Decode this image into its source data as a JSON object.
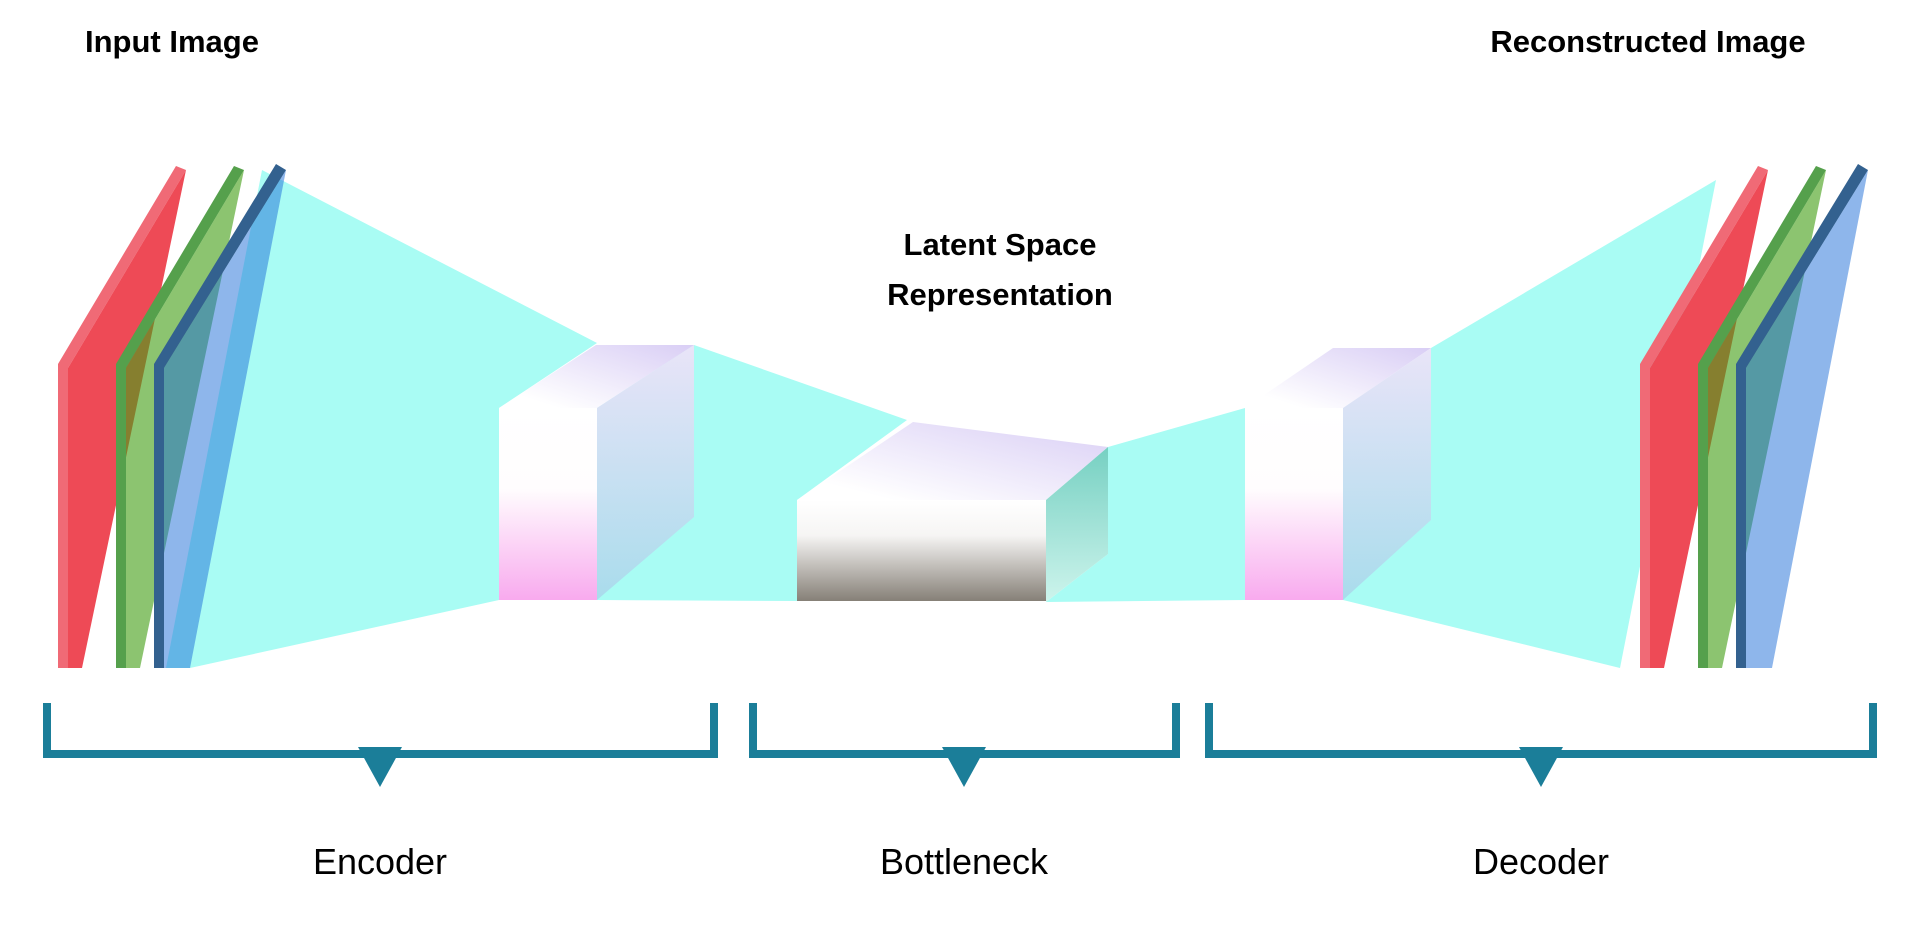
{
  "labels": {
    "input_image": "Input Image",
    "reconstructed_image": "Reconstructed Image",
    "latent_line1": "Latent Space",
    "latent_line2": "Representation",
    "encoder": "Encoder",
    "bottleneck": "Bottleneck",
    "decoder": "Decoder"
  },
  "colors": {
    "background": "#ffffff",
    "text": "#000000",
    "cyan_funnel": "#a9fcf4",
    "red_channel": "#ee4a56",
    "red_channel_edge": "#f06a76",
    "green_channel": "rgba(70,160,25,0.62)",
    "green_channel_edge": "#55a04c",
    "blue_channel": "rgba(30,110,215,0.5)",
    "blue_channel_edge": "#33618f",
    "box_white": "#ffffff",
    "box_white_mid": "#fffdfe",
    "box_pink": "#f8aaee",
    "box_lavender": "#d9cef5",
    "box_side_top": "#e9e4f8",
    "box_side_bottom": "#a9dcec",
    "bottleneck_gray_mid": "#f6f5f4",
    "bottleneck_gray": "#868077",
    "bottleneck_teal_dark": "#76d0c2",
    "bottleneck_teal_light": "#cdf4ec",
    "bracket": "#1b7e99"
  }
}
